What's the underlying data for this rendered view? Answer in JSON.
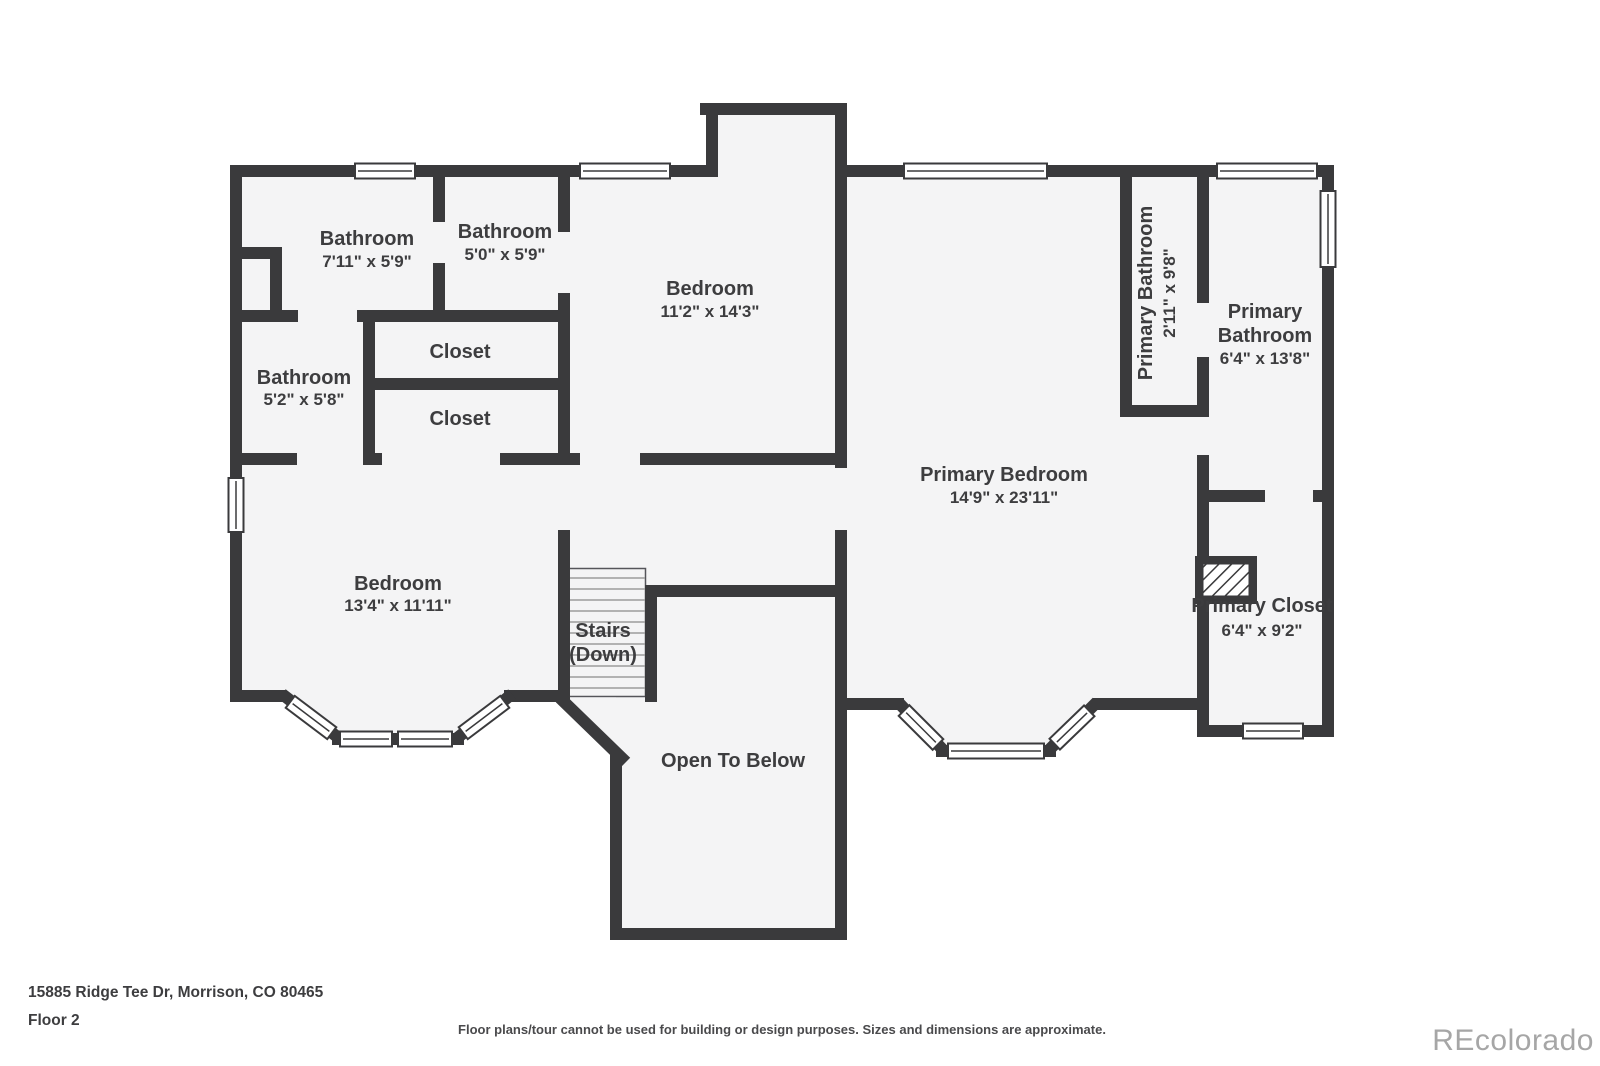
{
  "palette": {
    "wall": "#3a3a3c",
    "room_fill": "#f4f4f5",
    "label_text": "#3d3d3f",
    "watermark_text": "#a6a6a6",
    "background": "#ffffff"
  },
  "rooms": [
    {
      "name": "Bathroom",
      "dims": "7'11\" x 5'9\""
    },
    {
      "name": "Bathroom",
      "dims": "5'0\" x 5'9\""
    },
    {
      "name": "Bedroom",
      "dims": "11'2\" x 14'3\""
    },
    {
      "name": "Bathroom",
      "dims": "5'2\" x 5'8\""
    },
    {
      "name": "Closet"
    },
    {
      "name": "Closet"
    },
    {
      "name": "Bedroom",
      "dims": "13'4\" x 11'11\""
    },
    {
      "name": "Stairs",
      "dims": "(Down)"
    },
    {
      "name": "Open To Below"
    },
    {
      "name": "Primary Bedroom",
      "dims": "14'9\" x 23'11\""
    },
    {
      "name": "Primary Bathroom",
      "dims": "2'11\" x 9'8\""
    },
    {
      "name1": "Primary",
      "name2": "Bathroom",
      "dims": "6'4\" x 13'8\""
    },
    {
      "name": "Primary Closet",
      "dims": "6'4\" x 9'2\""
    }
  ],
  "footer": {
    "address": "15885 Ridge Tee Dr, Morrison, CO 80465",
    "floor_label": "Floor 2",
    "disclaimer": "Floor plans/tour cannot be used for building or design purposes. Sizes and dimensions are approximate.",
    "watermark": "REcolorado"
  }
}
